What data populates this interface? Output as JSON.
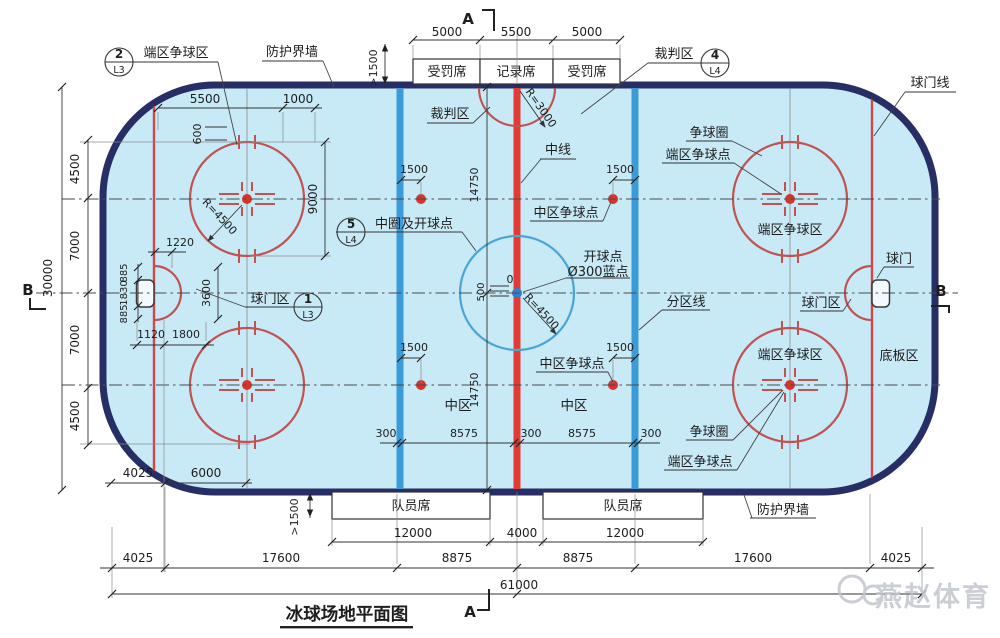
{
  "title": {
    "text": "冰球场地平面图"
  },
  "watermark": {
    "text": "燕赵体育"
  },
  "section_marks": {
    "a": "A",
    "b": "B"
  },
  "benches": {
    "penalty": "受罚席",
    "recorder": "记录席",
    "players": "队员席"
  },
  "callouts": {
    "c2": {
      "num": "2",
      "sheet": "L3"
    },
    "c4": {
      "num": "4",
      "sheet": "L4"
    },
    "c5": {
      "num": "5",
      "sheet": "L4"
    },
    "c1": {
      "num": "1",
      "sheet": "L3"
    }
  },
  "labels": {
    "end_faceoff_area": "端区争球区",
    "protective_wall": "防护界墙",
    "referee_area": "裁判区",
    "goal_line": "球门线",
    "center_line": "中线",
    "faceoff_circle": "争球圈",
    "end_faceoff_spot": "端区争球点",
    "neutral_faceoff_spot": "中区争球点",
    "center_circle_point": "中圈及开球点",
    "faceoff_point": "开球点",
    "blue_dot": "Ø300蓝点",
    "zone_line": "分区线",
    "goal_area": "球门区",
    "goal": "球门",
    "board_area": "底板区",
    "neutral_zone": "中区"
  },
  "dims": {
    "d5000": "5000",
    "d5500": "5500",
    "d1000": "1000",
    "d600": "600",
    "d9000": "9000",
    "r4500": "R=4500",
    "r3000": "R=3000",
    "d1220": "1220",
    "d3600": "3600",
    "d885": "885",
    "d1830": "1830",
    "d1120": "1120",
    "d1800": "1800",
    "d30000": "30000",
    "d4500": "4500",
    "d7000": "7000",
    "d4025": "4025",
    "d6000": "6000",
    "d1500": "1500",
    "gt1500": ">1500",
    "d14750": "14750",
    "d500": "500",
    "d0": "0",
    "d300": "300",
    "d8575": "8575",
    "d12000": "12000",
    "d4000": "4000",
    "d17600": "17600",
    "d8875": "8875",
    "d61000": "61000"
  },
  "colors": {
    "rink_fill": "#c8e9f6",
    "board_border": "#272e66",
    "center_red_line": "#e23b36",
    "blue_zone_line": "#3b9bd8",
    "goal_line_red": "#cf4746",
    "faceoff_red": "#c05352",
    "faceoff_dot": "#d5342b",
    "center_circle_blue": "#49a5d4",
    "center_dot_blue": "#2f7fd0"
  }
}
